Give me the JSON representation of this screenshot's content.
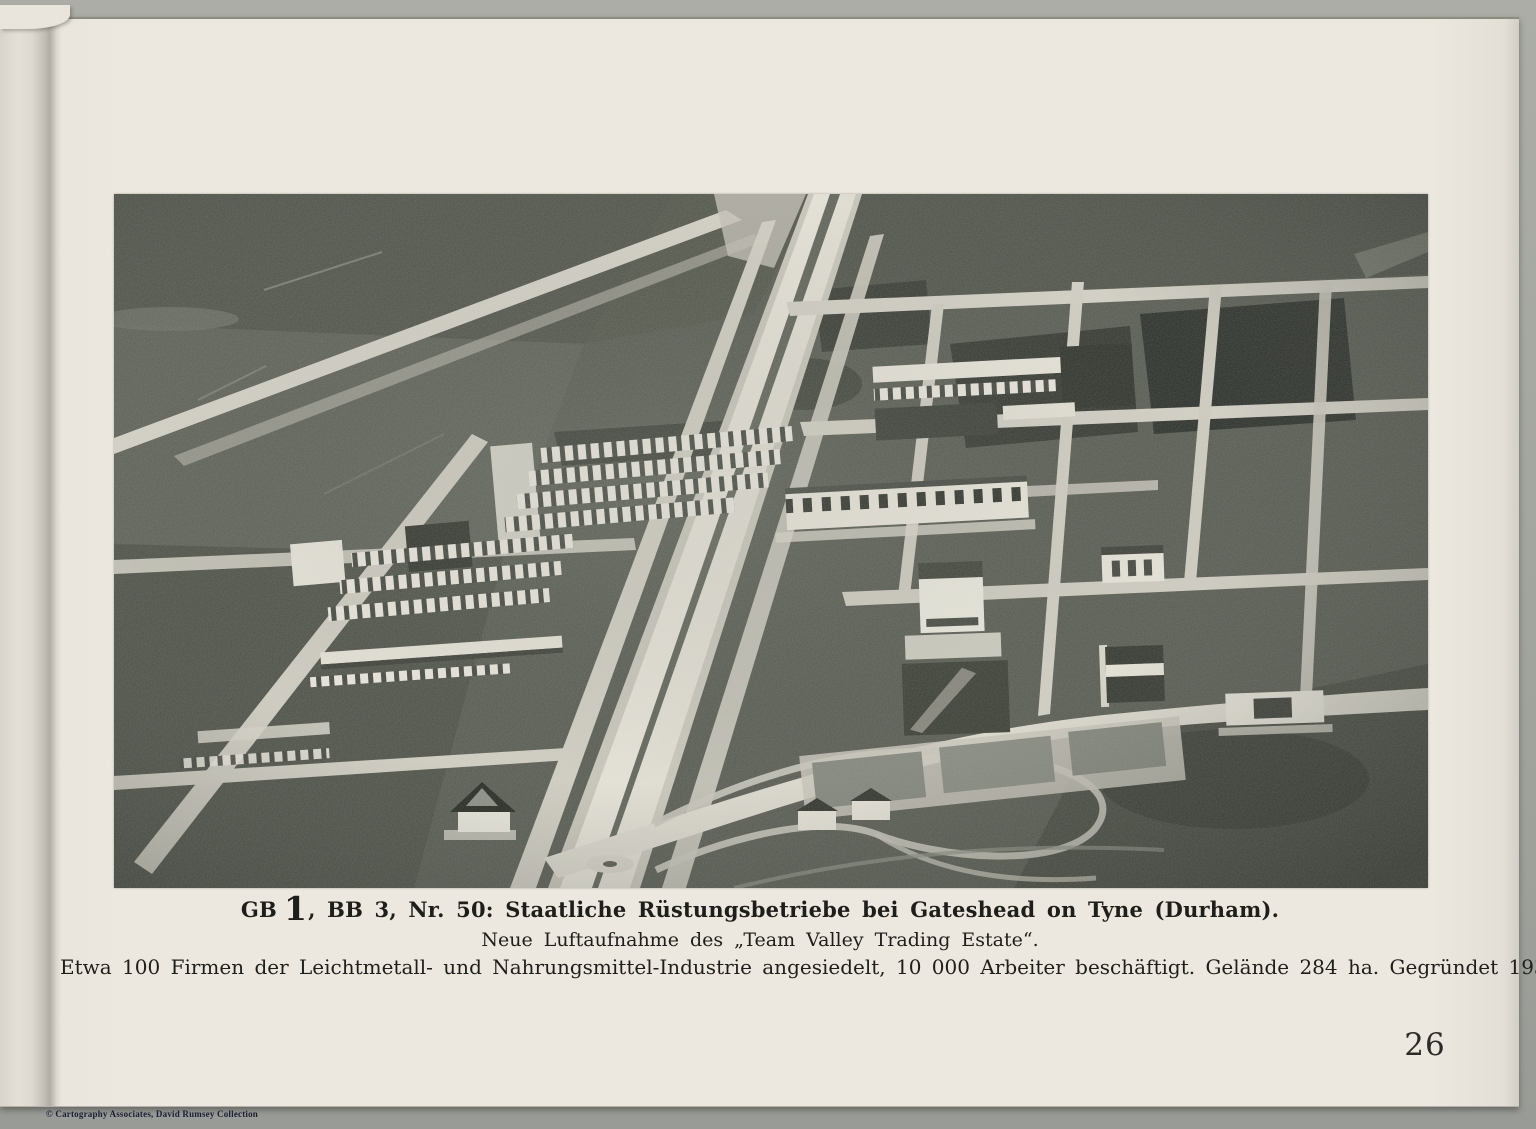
{
  "document": {
    "kind": "scanned book page with aerial photograph",
    "page_background": "#ece8df",
    "scan_background": "#a2a49e"
  },
  "photo": {
    "alt": "Aerial photograph of the Team Valley Trading Estate near Gateshead on Tyne: a straight dual-carriageway boulevard runs diagonally through fields lined with white factory buildings and cross streets",
    "base_color": "#575b52",
    "road_color": "#d6d3c8",
    "building_color": "#eceadf"
  },
  "caption": {
    "line1_prefix": "GB",
    "line1_numeral": "1",
    "line1_rest": ", BB 3, Nr. 50: Staatliche Rüstungsbetriebe bei Gateshead on Tyne (Durham).",
    "line2": "Neue Luftaufnahme des „Team Valley Trading Estate“.",
    "line3": "Etwa 100 Firmen der Leichtmetall- und Nahrungsmittel-Industrie angesiedelt, 10 000 Arbeiter beschäftigt. Gelände 284 ha. Gegründet 1936."
  },
  "page_number": "26",
  "footer": {
    "copyright": "© Cartography Associates, David Rumsey Collection"
  }
}
